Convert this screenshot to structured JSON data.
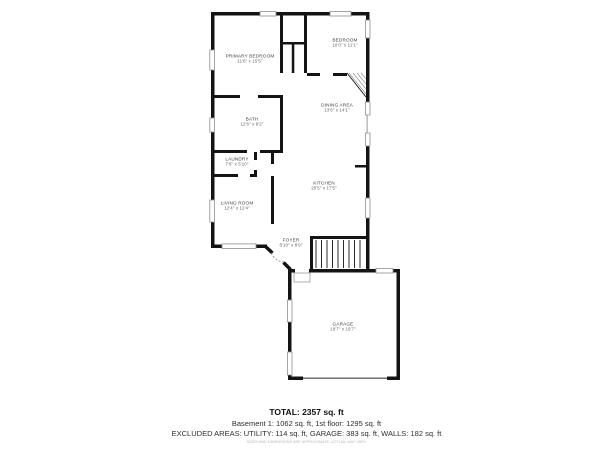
{
  "plan": {
    "rooms": [
      {
        "id": "primary-bedroom",
        "name": "PRIMARY BEDROOM",
        "dims": "11'6\" x 15'5\""
      },
      {
        "id": "bedroom",
        "name": "BEDROOM",
        "dims": "10'0\" x 11'1\""
      },
      {
        "id": "dining-area",
        "name": "DINING AREA",
        "dims": "13'6\" x 14'1\""
      },
      {
        "id": "bath",
        "name": "BATH",
        "dims": "12'6\" x 9'2\""
      },
      {
        "id": "laundry",
        "name": "LAUNDRY",
        "dims": "7'6\" x 5'10\""
      },
      {
        "id": "living-room",
        "name": "LIVING ROOM",
        "dims": "12'4\" x 12'4\""
      },
      {
        "id": "kitchen",
        "name": "KITCHEN",
        "dims": "20'5\" x 17'5\""
      },
      {
        "id": "foyer",
        "name": "FOYER",
        "dims": "8'10\" x 8'9\""
      },
      {
        "id": "garage",
        "name": "GARAGE",
        "dims": "19'7\" x 19'7\""
      }
    ]
  },
  "summary": {
    "total": "TOTAL: 2357 sq. ft",
    "floors": "Basement 1: 1062 sq. ft, 1st floor: 1295 sq. ft",
    "excluded": "EXCLUDED AREAS: UTILITY: 114 sq. ft, GARAGE: 383 sq. ft, WALLS: 182 sq. ft",
    "disclaimer": "SIZES AND DIMENSIONS ARE APPROXIMATE, ACTUAL MAY VARY"
  },
  "colors": {
    "wall": "#141414",
    "window_stroke": "#8f8f8f",
    "room_label": "#3f3f3f",
    "room_dims": "#5f5f5f",
    "summary_text": "#2e2e2e",
    "total_text": "#101010",
    "disclaimer_text": "#b8b8b8",
    "background": "#ffffff"
  }
}
